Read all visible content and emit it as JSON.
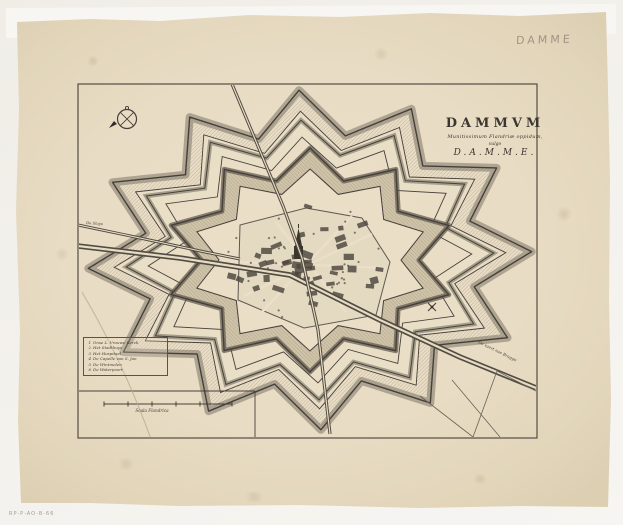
{
  "sheet": {
    "kind": "antique engraved town plan on laid paper",
    "paper_color": "#e8dcc4",
    "ink_color": "#46403a",
    "background_color": "#f3f1ec"
  },
  "title": {
    "main": "DAMMVM",
    "sub1": "Munitissimum Flandriæ oppidum,",
    "sub2": "vulgo",
    "sub3": "D.A.M.M.E."
  },
  "annotations": {
    "pencil_note": "DAMME",
    "catalog_number": "RP-P-AO-B-66"
  },
  "labels": {
    "canal": "De vaert nae Brugge",
    "road_left": "De Sluys",
    "scale_bar": "Scala Flandrica"
  },
  "legend": {
    "items": [
      {
        "num": "1",
        "label": "Onse L. Vrouwe Kerck"
      },
      {
        "num": "2",
        "label": "Het Stadthuys"
      },
      {
        "num": "3",
        "label": "Het Hospitael"
      },
      {
        "num": "4",
        "label": "De Capelle van S. Jan"
      },
      {
        "num": "5",
        "label": "De Wintmolen"
      },
      {
        "num": "6",
        "label": "De Waterpoort"
      }
    ]
  },
  "icons": {
    "compass": "compass-rose-icon",
    "windmill": "windmill-icon",
    "church": "church-tower-icon"
  }
}
